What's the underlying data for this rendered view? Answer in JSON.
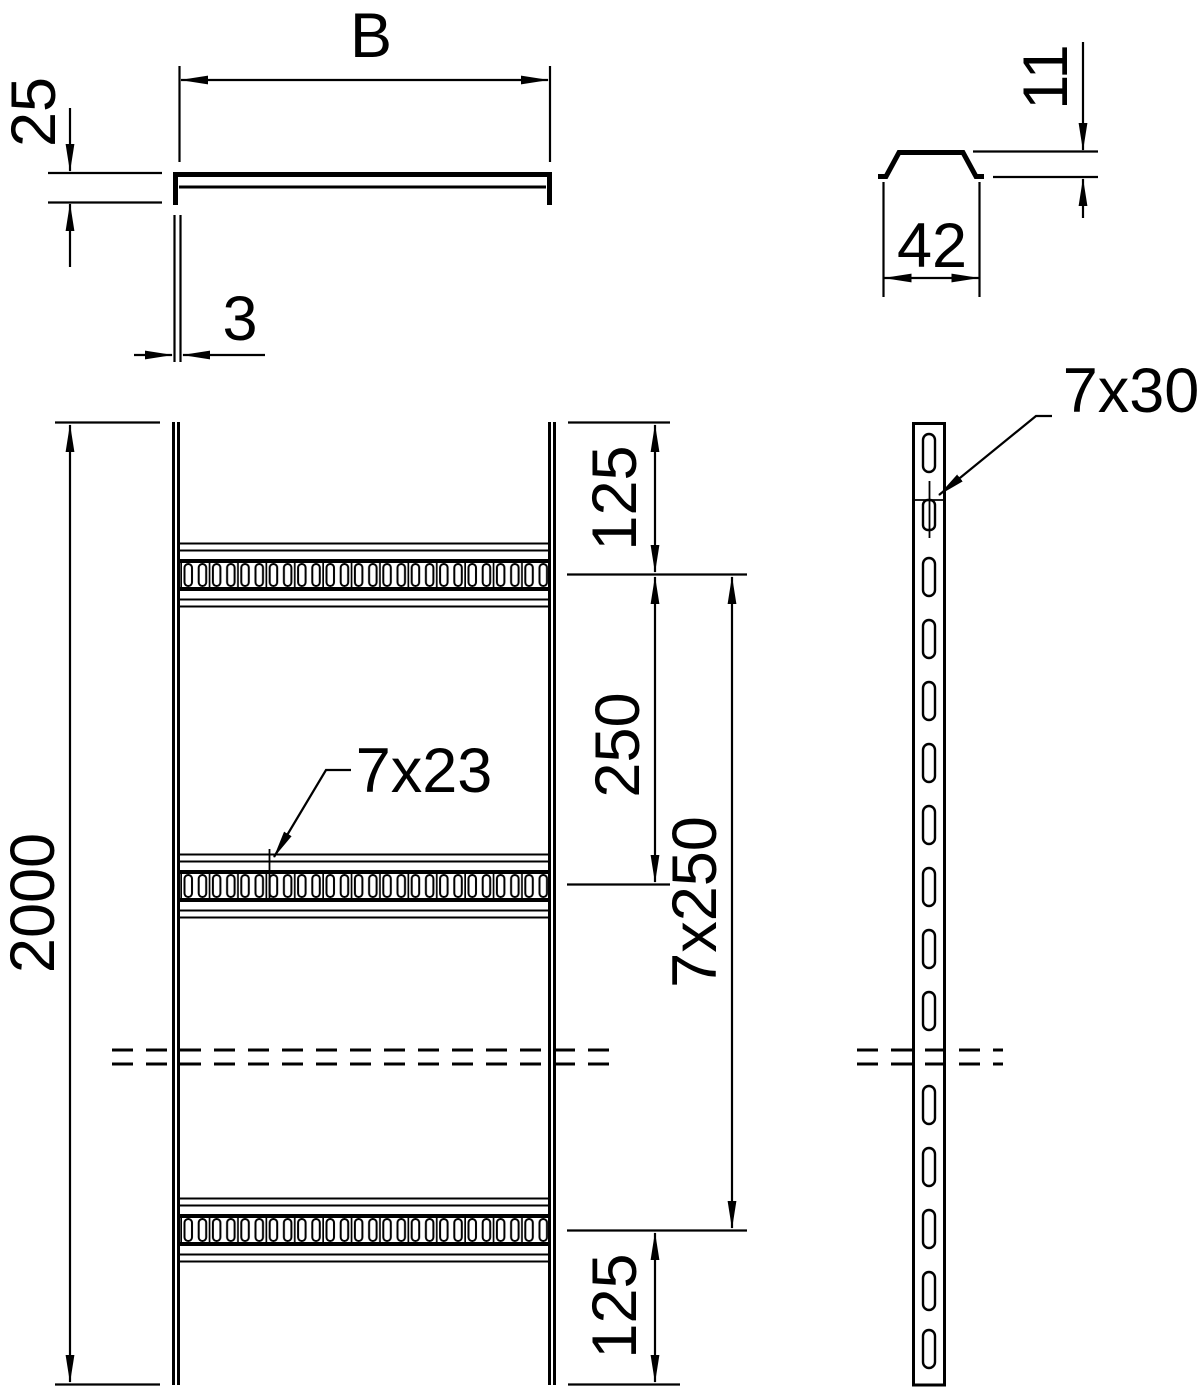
{
  "labels": {
    "cross_section": {
      "width": "B",
      "height": "25",
      "thickness": "3"
    },
    "rung_profile": {
      "height": "11",
      "width": "42"
    },
    "front_view": {
      "overall_length": "2000",
      "top_end_spacing": "125",
      "rung_pitch": "250",
      "rung_pitch_total": "7x250",
      "bottom_end_spacing": "125",
      "rung_slot_callout": "7x23"
    },
    "side_view": {
      "rail_slot_callout": "7x30"
    }
  },
  "colors": {
    "line": "#000000",
    "background": "#ffffff"
  }
}
